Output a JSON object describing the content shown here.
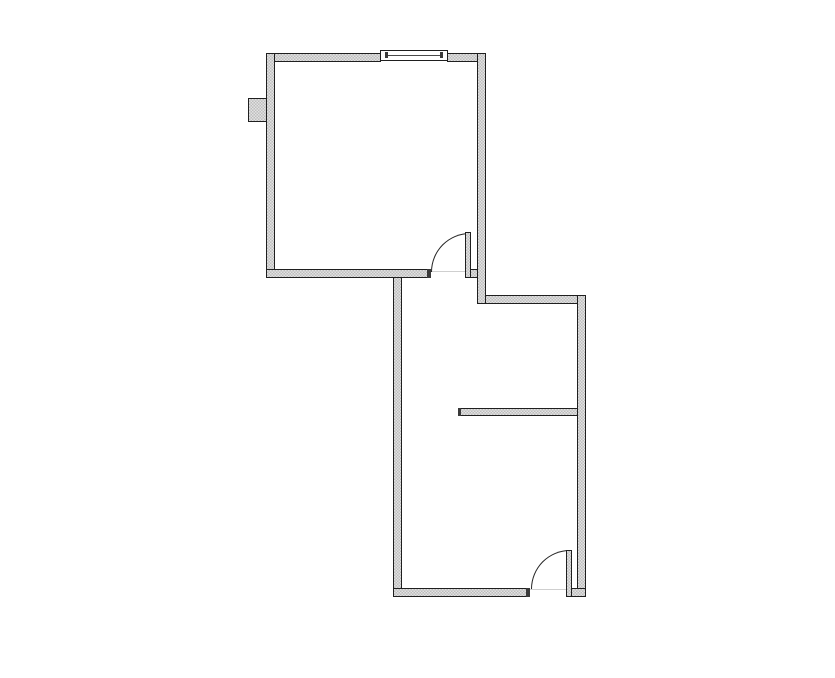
{
  "canvas": {
    "width": 835,
    "height": 678,
    "background": "#ffffff"
  },
  "palette": {
    "wall_outline": "#1f1f1f",
    "stipple_light": "#e3e3e3",
    "stipple_dark": "#bdbdbd",
    "cap_color": "#3a3a3a",
    "arc_color": "#222222",
    "threshold_color": "#cfcfcf",
    "window_fill": "#ffffff",
    "window_line": "#4a4a4a"
  },
  "floor_plan": {
    "description": "Two-room floor plan: upper-left square room with top window, left wall projection box and bottom door; lower-right rectangular room with interior partition wall and bottom-right door",
    "elements": [
      {
        "type": "region",
        "name": "room1-floor",
        "x": 275,
        "y": 62,
        "w": 202,
        "h": 207
      },
      {
        "type": "region",
        "name": "room2-floor",
        "x": 402,
        "y": 278,
        "w": 175,
        "h": 310
      },
      {
        "type": "wall",
        "name": "room2-left-wall",
        "x": 393,
        "y": 269,
        "w": 9,
        "h": 328
      },
      {
        "type": "wall",
        "name": "room2-partition-wall",
        "x": 458,
        "y": 408,
        "w": 121,
        "h": 8
      },
      {
        "type": "cap",
        "name": "partition-end-cap",
        "x": 458,
        "y": 408,
        "w": 3,
        "h": 8
      },
      {
        "type": "wall",
        "name": "room2-top-wall",
        "x": 477,
        "y": 295,
        "w": 109,
        "h": 9
      },
      {
        "type": "wall",
        "name": "room2-right-wall",
        "x": 577,
        "y": 295,
        "w": 9,
        "h": 302
      },
      {
        "type": "wall",
        "name": "room2-bottom-wall-left",
        "x": 393,
        "y": 588,
        "w": 137,
        "h": 9
      },
      {
        "type": "wall",
        "name": "room2-bottom-wall-right",
        "x": 566,
        "y": 588,
        "w": 20,
        "h": 9
      },
      {
        "type": "wall",
        "name": "wall-projection-box",
        "x": 248,
        "y": 98,
        "w": 22,
        "h": 24
      },
      {
        "type": "wall",
        "name": "room1-top-wall-left",
        "x": 266,
        "y": 53,
        "w": 115,
        "h": 9
      },
      {
        "type": "wall",
        "name": "room1-top-wall-right",
        "x": 447,
        "y": 53,
        "w": 39,
        "h": 9
      },
      {
        "type": "wall",
        "name": "room1-left-wall",
        "x": 266,
        "y": 53,
        "w": 9,
        "h": 225
      },
      {
        "type": "wall",
        "name": "room1-bottom-wall",
        "x": 266,
        "y": 269,
        "w": 165,
        "h": 9
      },
      {
        "type": "wall",
        "name": "room1-bottom-wall-stub",
        "x": 470,
        "y": 269,
        "w": 16,
        "h": 9
      },
      {
        "type": "wall",
        "name": "room1-right-wall",
        "x": 477,
        "y": 53,
        "w": 9,
        "h": 251
      },
      {
        "type": "cap",
        "name": "door1-jamb-cap",
        "x": 427,
        "y": 269,
        "w": 4,
        "h": 9
      },
      {
        "type": "cap",
        "name": "door2-jamb-cap",
        "x": 526,
        "y": 588,
        "w": 4,
        "h": 9
      },
      {
        "type": "line",
        "name": "door1-threshold",
        "x": 431,
        "y": 271,
        "w": 35,
        "h": 1
      },
      {
        "type": "line",
        "name": "door2-threshold",
        "x": 530,
        "y": 589,
        "w": 37,
        "h": 1
      },
      {
        "type": "arc",
        "name": "door1-swing-arc",
        "x": 431,
        "y": 233,
        "w": 39,
        "h": 39
      },
      {
        "type": "arc",
        "name": "door2-swing-arc",
        "x": 531,
        "y": 550,
        "w": 39,
        "h": 39
      },
      {
        "type": "leaf",
        "name": "door1-leaf",
        "x": 465,
        "y": 232,
        "w": 6,
        "h": 46
      },
      {
        "type": "leaf",
        "name": "door2-leaf",
        "x": 566,
        "y": 550,
        "w": 6,
        "h": 47
      },
      {
        "type": "rect",
        "name": "window-frame",
        "x": 380,
        "y": 50,
        "w": 68,
        "h": 11,
        "fill": "#ffffff"
      },
      {
        "type": "line",
        "name": "window-center-line",
        "x": 386,
        "y": 55,
        "w": 56,
        "h": 1,
        "fill": "#4a4a4a"
      },
      {
        "type": "cap",
        "name": "window-left-tick",
        "x": 385,
        "y": 52,
        "w": 3,
        "h": 6
      },
      {
        "type": "cap",
        "name": "window-right-tick",
        "x": 440,
        "y": 52,
        "w": 3,
        "h": 6
      }
    ]
  }
}
